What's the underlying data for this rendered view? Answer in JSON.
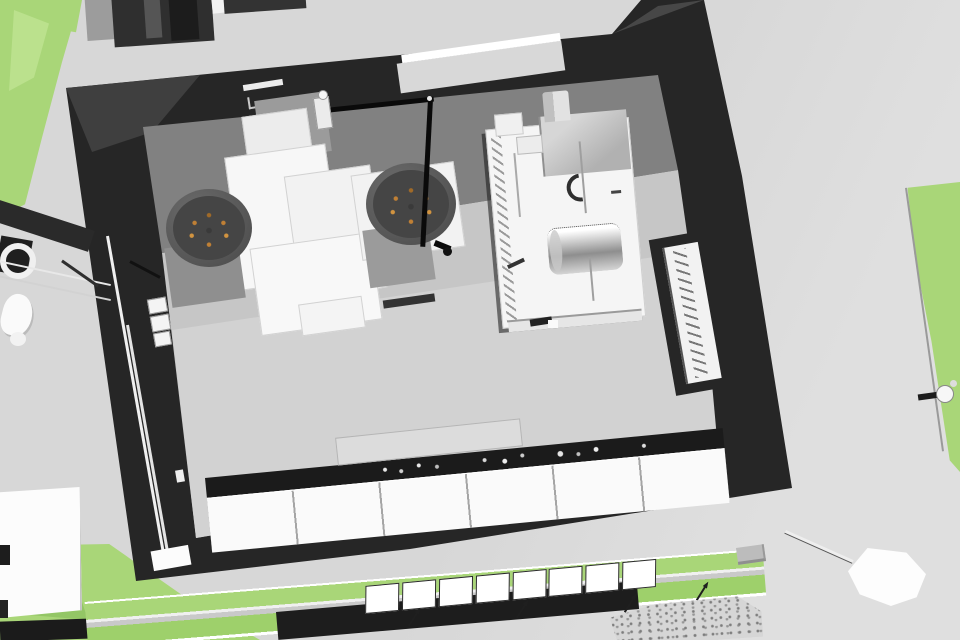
{
  "meta": {
    "kind": "3d-architectural-render",
    "view": "overhead perspective of a building interior (commercial kitchen / plant room) with surrounding pavement and landscaping",
    "width_px": 960,
    "height_px": 640,
    "visible_text": "none"
  },
  "palette": {
    "pavement": "#d7d7d7",
    "pavementLight": "#dfdfdf",
    "grass": "#a9d678",
    "grassLight": "#bfe392",
    "grassDark": "#8abf5c",
    "grassDark2": "#9ed06b",
    "wallDark": "#262626",
    "wallMid": "#2f2f2f",
    "faceGray": "#818181",
    "floorGray": "#c6c6c6",
    "floorLight": "#d2d2d2",
    "counterWhite": "#fafafa",
    "equipWhite": "#f3f3f3",
    "grayPatch": "#9b9b9b",
    "boxGray": "#b1b1b1",
    "steelDark": "#8e8e8e",
    "cylBody": "#565656",
    "cylTop": "#454545",
    "knobOrange": "#c08035",
    "pipeBlack": "#0a0a0a",
    "countertopDark": "#1b1b1b",
    "trayGray": "#dcdcdc"
  },
  "scene": {
    "environment": [
      {
        "name": "pavement",
        "color": "#d7d7d7"
      },
      {
        "name": "grass-patch-top-left",
        "color": "#a9d678"
      },
      {
        "name": "grass-strip-right-edge",
        "color": "#a9d678"
      },
      {
        "name": "grass-area-bottom-left",
        "color": "#a9d678"
      },
      {
        "name": "planting-strips-with-fence-bottom",
        "color": "#9ed06b"
      },
      {
        "name": "gravel-patch-bottom-center",
        "color": "#d6d6d6"
      },
      {
        "name": "neighbouring-structure-top-edge",
        "color": "#2f2f2f"
      },
      {
        "name": "white-slab-bottom-left",
        "color": "#fcfcfc"
      }
    ],
    "building": {
      "walls_color": "#262626",
      "back_wall_face_color": "#818181",
      "floor_color": "#c6c6c6",
      "features": [
        {
          "name": "north-wall-window",
          "parts": [
            "light sill",
            "white glazing strip"
          ]
        },
        {
          "name": "east-wall-ladder-window",
          "parts": [
            "white slot",
            "diagonal ladder rungs"
          ]
        },
        {
          "name": "west-wall-service-pipes",
          "parts": [
            "two thin white risers",
            "three wall boxes",
            "low white panel"
          ]
        }
      ]
    },
    "interior_objects": [
      {
        "name": "stepped-white-platform",
        "color": "#f3f3f3"
      },
      {
        "name": "kettle-cylinder-left",
        "color": "#565656",
        "top_knobs": "#c08035"
      },
      {
        "name": "kettle-cylinder-right",
        "color": "#565656",
        "top_knobs": "#c08035"
      },
      {
        "name": "black-overhead-pipe-with-elbow",
        "color": "#0a0a0a"
      },
      {
        "name": "white-pipe-valve",
        "color": "#ebebeb"
      },
      {
        "name": "equipment-island",
        "parts": [
          "white table",
          "gray hood box",
          "chimney",
          "stainless roller cylinder",
          "crescent mark",
          "hatched edge"
        ]
      },
      {
        "name": "south-counter-run",
        "parts": [
          "dark countertop with small dishes",
          "six white cabinet fronts",
          "light tray"
        ]
      }
    ],
    "props": [
      {
        "name": "bench-pump-cluster-left-edge"
      },
      {
        "name": "signpost-with-white-paddle-bottom-right"
      },
      {
        "name": "gray-brick"
      },
      {
        "name": "tap-fixture-right-edge"
      },
      {
        "name": "fence-posts",
        "count": 4
      },
      {
        "name": "roof-panels-row",
        "count": 8
      }
    ]
  }
}
